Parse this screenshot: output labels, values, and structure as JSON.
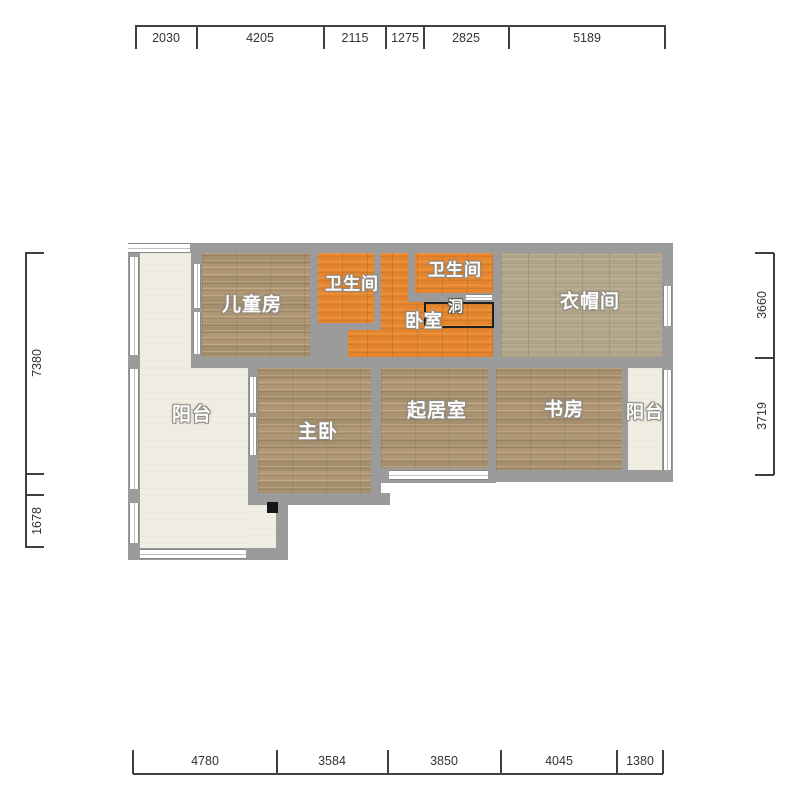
{
  "title": "apartment-floor-plan",
  "rooms": {
    "children_room": "儿童房",
    "bathroom_1": "卫生间",
    "bathroom_2": "卫生间",
    "bedroom": "卧室",
    "hole": "洞",
    "cloakroom": "衣帽间",
    "balcony_left": "阳台",
    "master_bedroom": "主卧",
    "living_room": "起居室",
    "study": "书房",
    "balcony_right": "阳台"
  },
  "dimensions": {
    "top": {
      "values": [
        "2030",
        "4205",
        "2115",
        "1275",
        "2825",
        "5189"
      ]
    },
    "bottom": {
      "values": [
        "4780",
        "3584",
        "3850",
        "4045",
        "1380"
      ]
    },
    "left": {
      "values": [
        "7380",
        "1678"
      ]
    },
    "right": {
      "values": [
        "3660",
        "3719"
      ]
    }
  },
  "colors": {
    "wall": "#9b9b9b",
    "wood_floor": "#b09876",
    "tile_floor": "#b2a489",
    "accent_orange_floor": "#e5862f",
    "balcony_floor": "#f0ede2",
    "dimension_text": "#333333",
    "label_text": "#fdfdfd"
  }
}
